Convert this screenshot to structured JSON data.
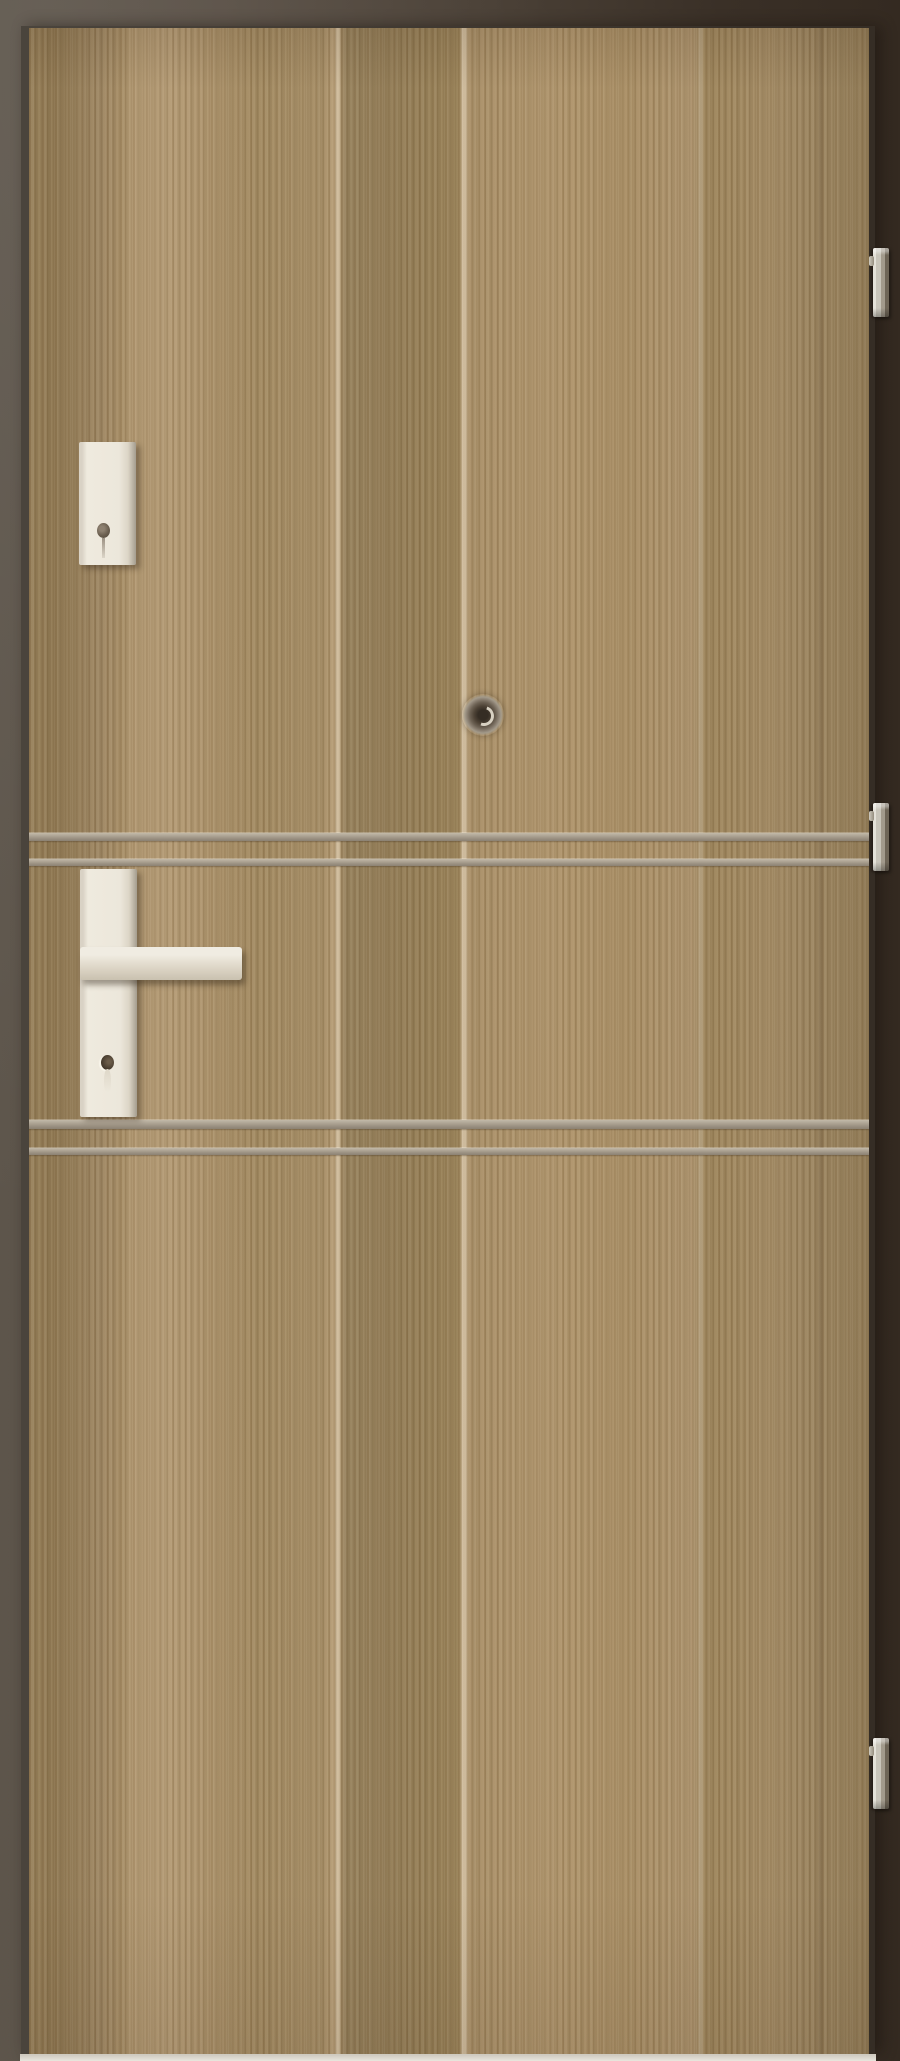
{
  "scene": {
    "type": "product-photo",
    "subject": "interior security door, vertical walnut-grain laminate finish",
    "background": "dark brown studio backdrop, lighter at left, darker at right",
    "text_visible": "none"
  },
  "colors": {
    "bg_light": "#5d554b",
    "bg_mid": "#4a4036",
    "bg_dark": "#342a21",
    "edge_dark": "#4a443c",
    "edge_shadow": "#352d25",
    "wood_base": "#a58c63",
    "inlay_light": "#c2b9a8",
    "inlay_dark": "#8b8172",
    "hardware_cream": "#ece7db",
    "hardware_shadow": "#a49c8e",
    "hinge_light": "#e4e1d8",
    "hinge_dark": "#6e6557",
    "floor": "#e9e6dd",
    "peep_dark": "#3b332a",
    "peep_highlight": "#d8d1c2",
    "keyhole_dark": "#4a3e30"
  },
  "door": {
    "hardware": {
      "hinges_count": 3,
      "inlay_strips_count": 4,
      "deadbolt_escutcheon": "rectangular cream plate with keyhole, upper left",
      "handle": "cream lever handle on long rectangular backplate with cylinder keyhole",
      "peephole": "round metal viewer, door center",
      "floor_line": "light strip under door bottom edge"
    }
  }
}
